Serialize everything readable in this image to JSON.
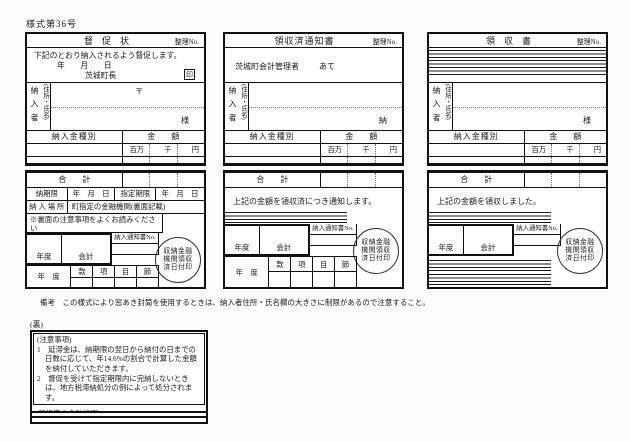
{
  "page": {
    "form_no": "様式第36号",
    "remarks": "備考　この様式により窓あき封筒を使用するときは、納入者住所・氏名欄の大きさに制限があるので注意すること。"
  },
  "panels": [
    {
      "title": "督　促　状",
      "ref_no": "整理No.",
      "notice": "下記のとおり納入されるよう督促します。",
      "date": "年　　月　　日",
      "issuer": "茨城町長",
      "seal": "印",
      "payer": "納入者",
      "payer_sub": "(住所・氏名)",
      "postal": "〒",
      "honorific": "様",
      "kind": "納入金種別",
      "amount": "金　　額",
      "million": "百万",
      "thousand": "千",
      "yen": "円",
      "total": "合　　計",
      "due_label": "納期限",
      "due_date": "年　月　日",
      "designated_label": "指定期限",
      "designated_date": "年　月　日",
      "place_label": "納 入 場 所",
      "place_value": "町指定の金融機関(裏面記載)",
      "back_note": "※裏面の注意事項をよくお読みください",
      "year_label": "年度",
      "account_label": "会計",
      "notice_no": "納入通知書No.",
      "stamp": [
        "収納金融",
        "機関領収",
        "済日付印"
      ],
      "fy_label": "年　度",
      "budget_cols": [
        "款",
        "項",
        "目",
        "節"
      ]
    },
    {
      "title": "領収済通知書",
      "ref_no": "整理No.",
      "addressee": "茨城町会計管理者",
      "addressee_suffix": "あて",
      "payer": "納入者",
      "payer_sub": "(住所・氏名)",
      "honorific": "納",
      "kind": "納入金種別",
      "amount": "金　　額",
      "million": "百万",
      "thousand": "千",
      "yen": "円",
      "total": "合　　計",
      "message": "上記の金額を領収済につき通知します。",
      "year_label": "年度",
      "account_label": "会計",
      "notice_no": "納入通知書No.",
      "stamp": [
        "収納金融",
        "機関領収",
        "済日付印"
      ],
      "fy_label": "年　度",
      "budget_cols": [
        "款",
        "項",
        "目",
        "節"
      ]
    },
    {
      "title": "領　収　書",
      "ref_no": "整理No.",
      "payer": "納入者",
      "payer_sub": "(住所・氏名)",
      "honorific": "様",
      "kind": "納入金種別",
      "amount": "金　　額",
      "million": "百万",
      "thousand": "千",
      "yen": "円",
      "total": "合　　計",
      "message": "上記の金額を領収しました。",
      "year_label": "年度",
      "account_label": "会計",
      "notice_no": "納入通知書No.",
      "stamp": [
        "収納金融",
        "機関領収",
        "済日付印"
      ]
    }
  ],
  "back": {
    "label": "(裏)",
    "notes_title": "(注意事項)",
    "note1": "1　延滞金は、納期限の翌日から納付の日までの日数に応じて、年14.6%の割合で計算した金額を納付していただきます。",
    "note2": "2　督促を受けて指定期限内に完納しないときは、地方税滞納処分の例によって処分されます。",
    "bank": "(町指定の金融機関)"
  }
}
